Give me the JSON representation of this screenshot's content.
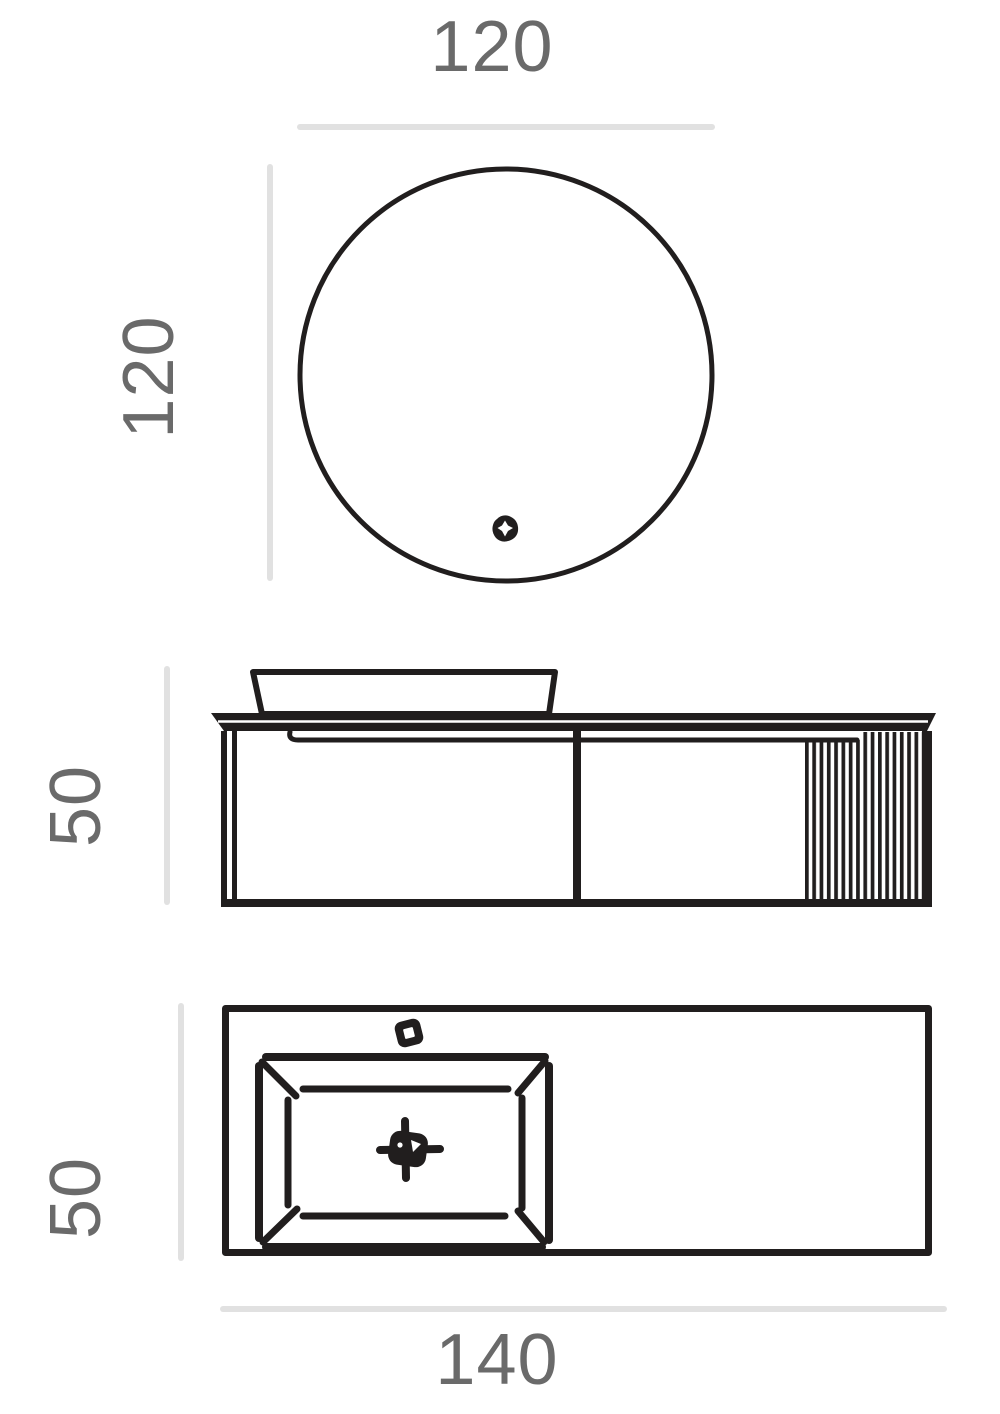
{
  "drawing": {
    "kind": "bathroom-vanity-technical-dimension-drawing",
    "views": {
      "mirror_front": {
        "name": "round-mirror-front-view",
        "width_label": "120",
        "height_label": "120"
      },
      "cabinet_front": {
        "name": "vanity-cabinet-front-view",
        "height_label": "50"
      },
      "countertop_top": {
        "name": "countertop-plan-view",
        "height_label": "50",
        "width_label": "140"
      }
    },
    "icons": {
      "mirror_switch": "touch-switch-icon",
      "faucet_hole": "faucet-hole-icon",
      "drain": "drain-icon"
    }
  },
  "colors": {
    "ink": "#211e1e",
    "dim_line": "#e1e1e1",
    "dim_text": "#6a6a6a",
    "bg": "#ffffff"
  }
}
